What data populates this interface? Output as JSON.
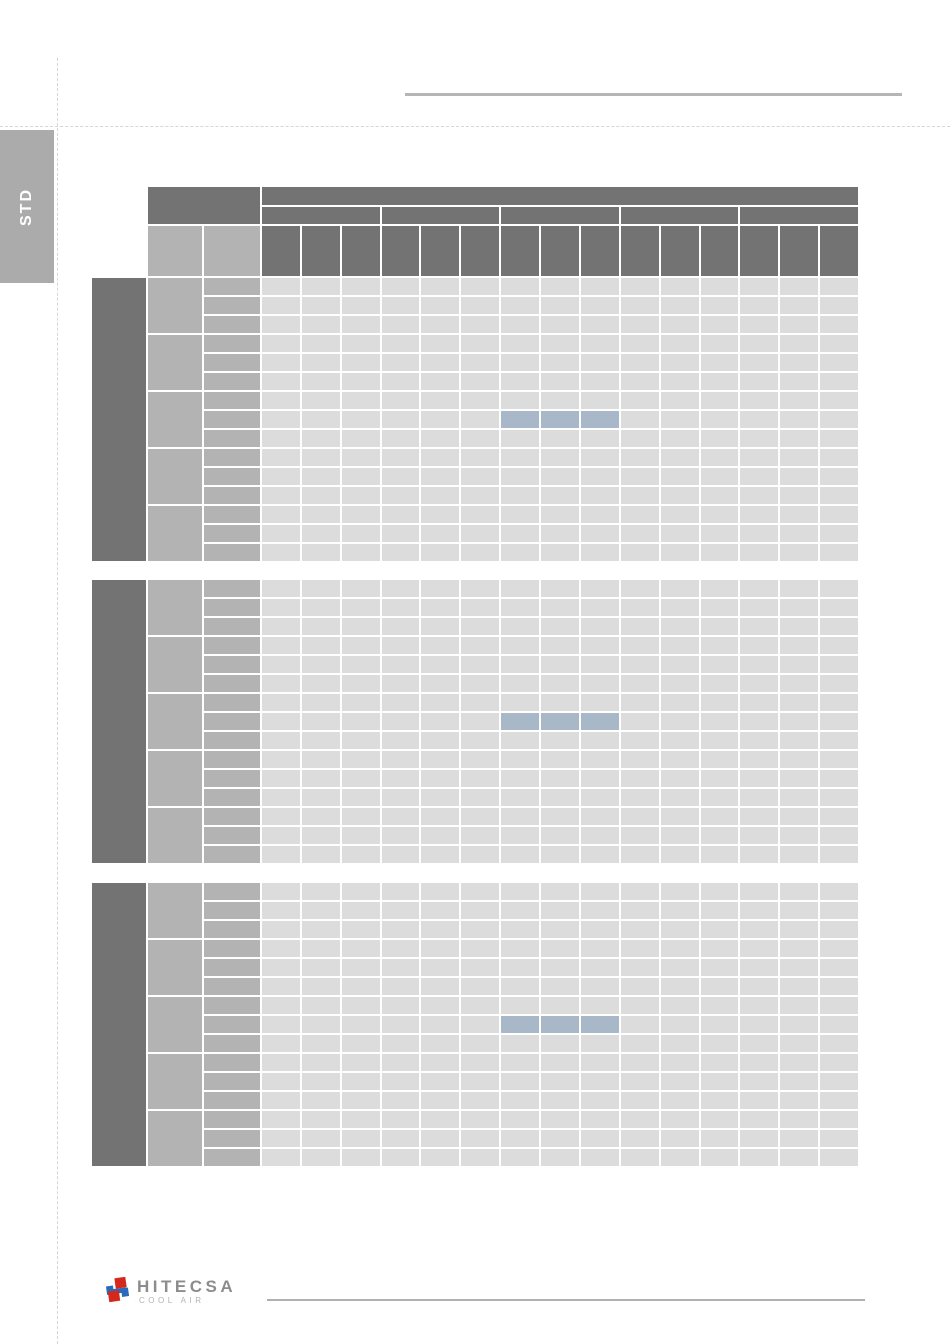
{
  "side_tab": {
    "label": "STD",
    "bg": "#ababab",
    "text_color": "#ffffff"
  },
  "rules": {
    "top_rule_color": "#b5b5b5",
    "footer_rule_color": "#b0b0b0",
    "dashed_guide_color": "#d6d6d6"
  },
  "tables": {
    "colors": {
      "header_dark": "#737373",
      "group_gray": "#b3b3b3",
      "cell_light": "#dcdcdc",
      "highlight_blue": "#a9b8c9",
      "grid_white": "#ffffff"
    },
    "columns": 15,
    "sub_header_groups": 5,
    "columns_per_sub_header": 3,
    "row_groups": 5,
    "rows_per_group": 3,
    "instances": [
      {
        "name": "capacity-table-1",
        "has_header": true,
        "highlight": {
          "row_index": 7,
          "col_start": 6,
          "col_span": 3
        }
      },
      {
        "name": "capacity-table-2",
        "has_header": false,
        "highlight": {
          "row_index": 7,
          "col_start": 6,
          "col_span": 3
        }
      },
      {
        "name": "capacity-table-3",
        "has_header": false,
        "highlight": {
          "row_index": 7,
          "col_start": 6,
          "col_span": 3
        }
      }
    ]
  },
  "footer": {
    "brand": "HITECSA",
    "tagline": "COOL AIR",
    "brand_color": "#8c8c8c",
    "tagline_color": "#b2b2b2",
    "logo_blue": "#2a6ab9",
    "logo_red": "#d5281c"
  }
}
